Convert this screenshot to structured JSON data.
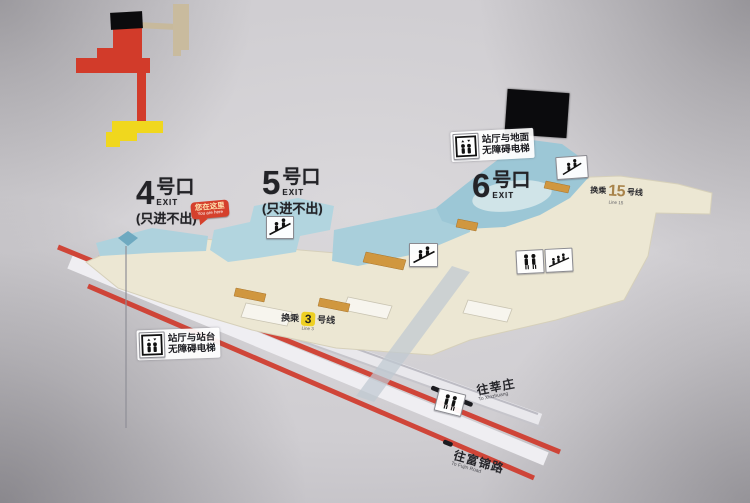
{
  "exits": [
    {
      "number": "4",
      "suffix": "号口",
      "exit_word": "EXIT",
      "note": "(只进不出)"
    },
    {
      "number": "5",
      "suffix": "号口",
      "exit_word": "EXIT",
      "note": "(只进不出)"
    },
    {
      "number": "6",
      "suffix": "号口",
      "exit_word": "EXIT",
      "note": ""
    }
  ],
  "you_are_here": {
    "label": "您在这里",
    "sublabel": "You are here"
  },
  "elevator_signs": {
    "hall_ground": {
      "line1": "站厅与地面",
      "line2": "无障碍电梯"
    },
    "hall_platform": {
      "line1": "站厅与站台",
      "line2": "无障碍电梯"
    }
  },
  "transfers": {
    "line3": {
      "prefix": "换乘",
      "number": "3",
      "suffix": "号线",
      "sub": "Line 3"
    },
    "line15": {
      "prefix": "换乘",
      "number": "15",
      "suffix": "号线",
      "sub": "Line 15"
    }
  },
  "directions": {
    "xinzhuang": {
      "label": "往莘庄",
      "sublabel": "To Xinzhuang"
    },
    "fujin": {
      "label": "往富锦路",
      "sublabel": "To Fujin Road"
    }
  },
  "icons": {
    "escalator": "escalator-icon",
    "stairs": "stairs-icon",
    "family_escalator": "family-escalator-icon",
    "elevator": "elevator-icon"
  },
  "colors": {
    "line1_red": "#cf3a2b",
    "line3_yellow": "#eed023",
    "line15_bronze": "#a8834a",
    "concourse_beige": "#ece7d3",
    "passage_blue": "#aed2dd",
    "ramp_orange": "#d0973f",
    "bubble_red": "#d5402c"
  }
}
